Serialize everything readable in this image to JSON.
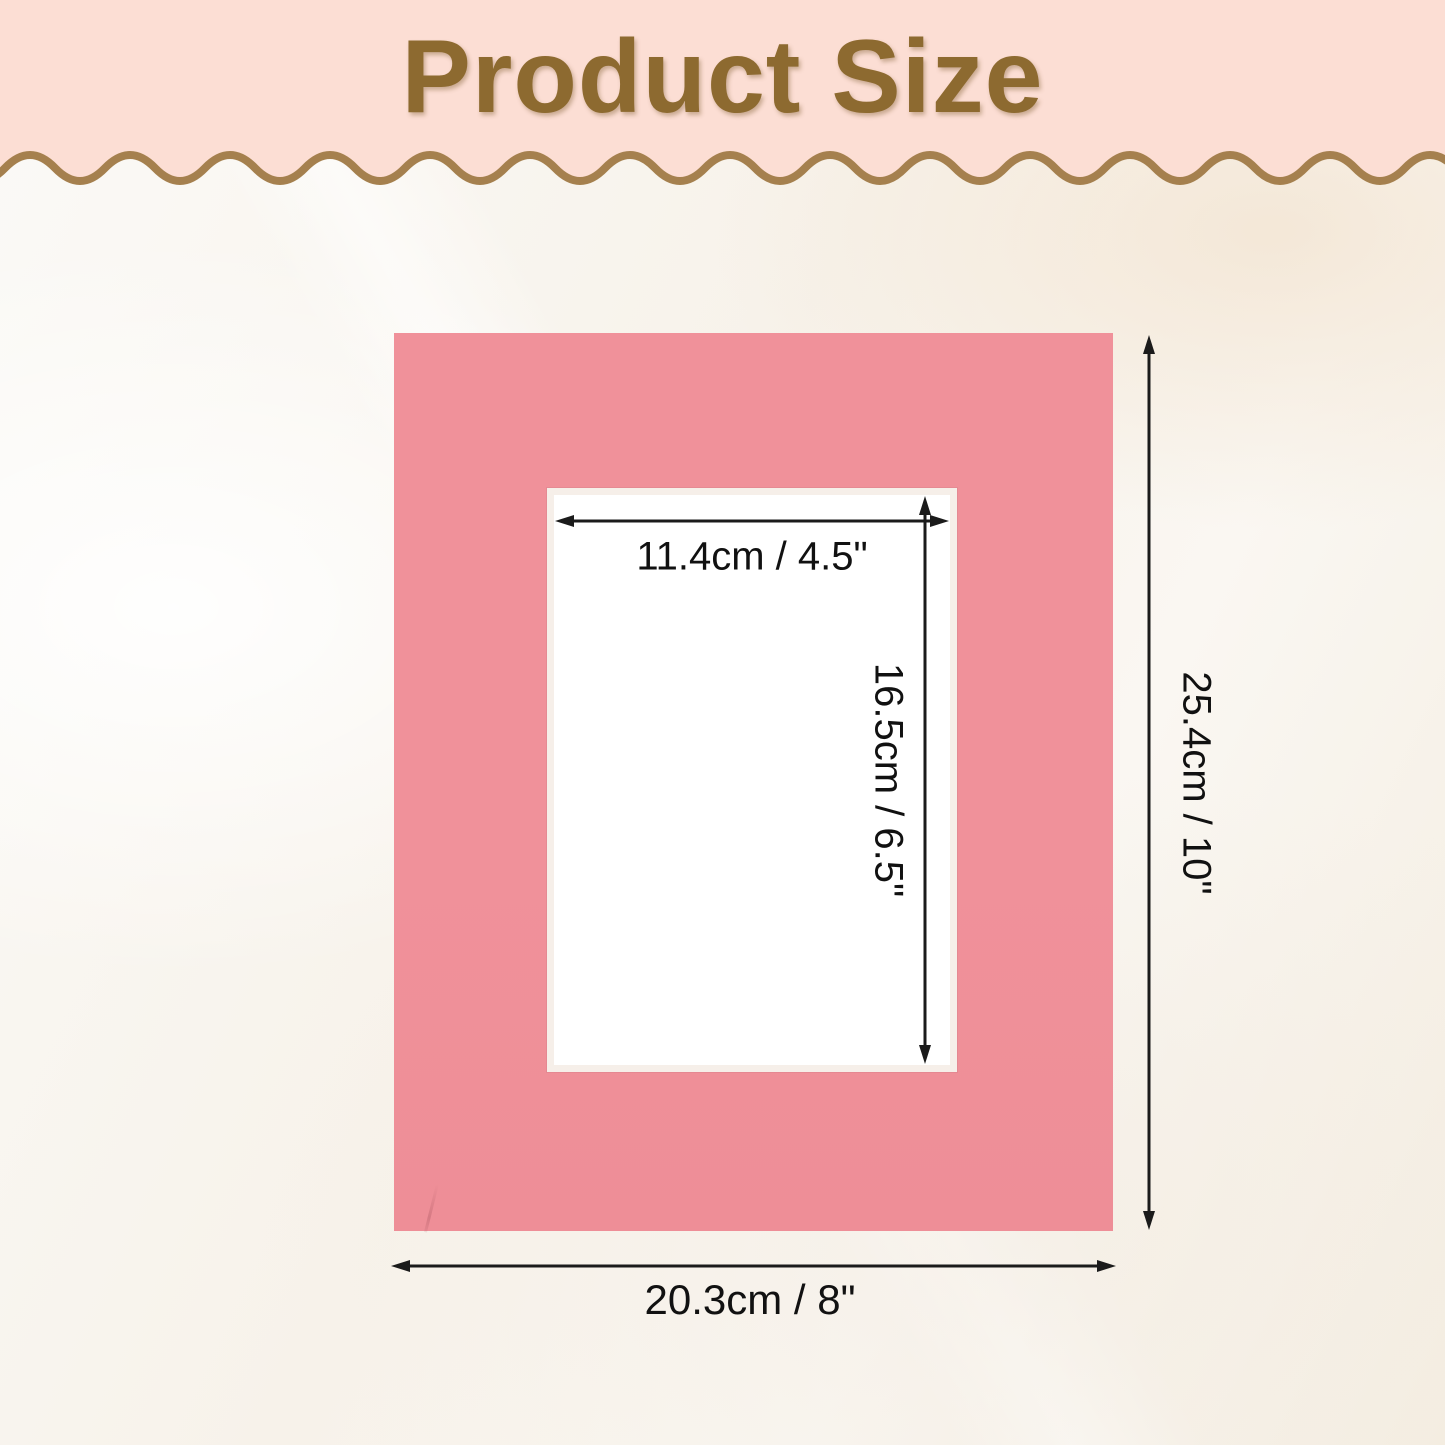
{
  "header": {
    "title": "Product Size"
  },
  "diagram": {
    "product": "picture mat board",
    "inner_width_label": "11.4cm / 4.5\"",
    "inner_height_label": "16.5cm / 6.5\"",
    "outer_height_label": "25.4cm / 10\"",
    "outer_width_label": "20.3cm / 8\""
  },
  "colors": {
    "header_bg": "#fcded4",
    "title": "#8d6a30",
    "wave": "#a5804e",
    "mat": "#f0919a",
    "mat_window_edge": "#f6efe9",
    "arrow": "#1b1b1b",
    "label_text": "#111111"
  }
}
